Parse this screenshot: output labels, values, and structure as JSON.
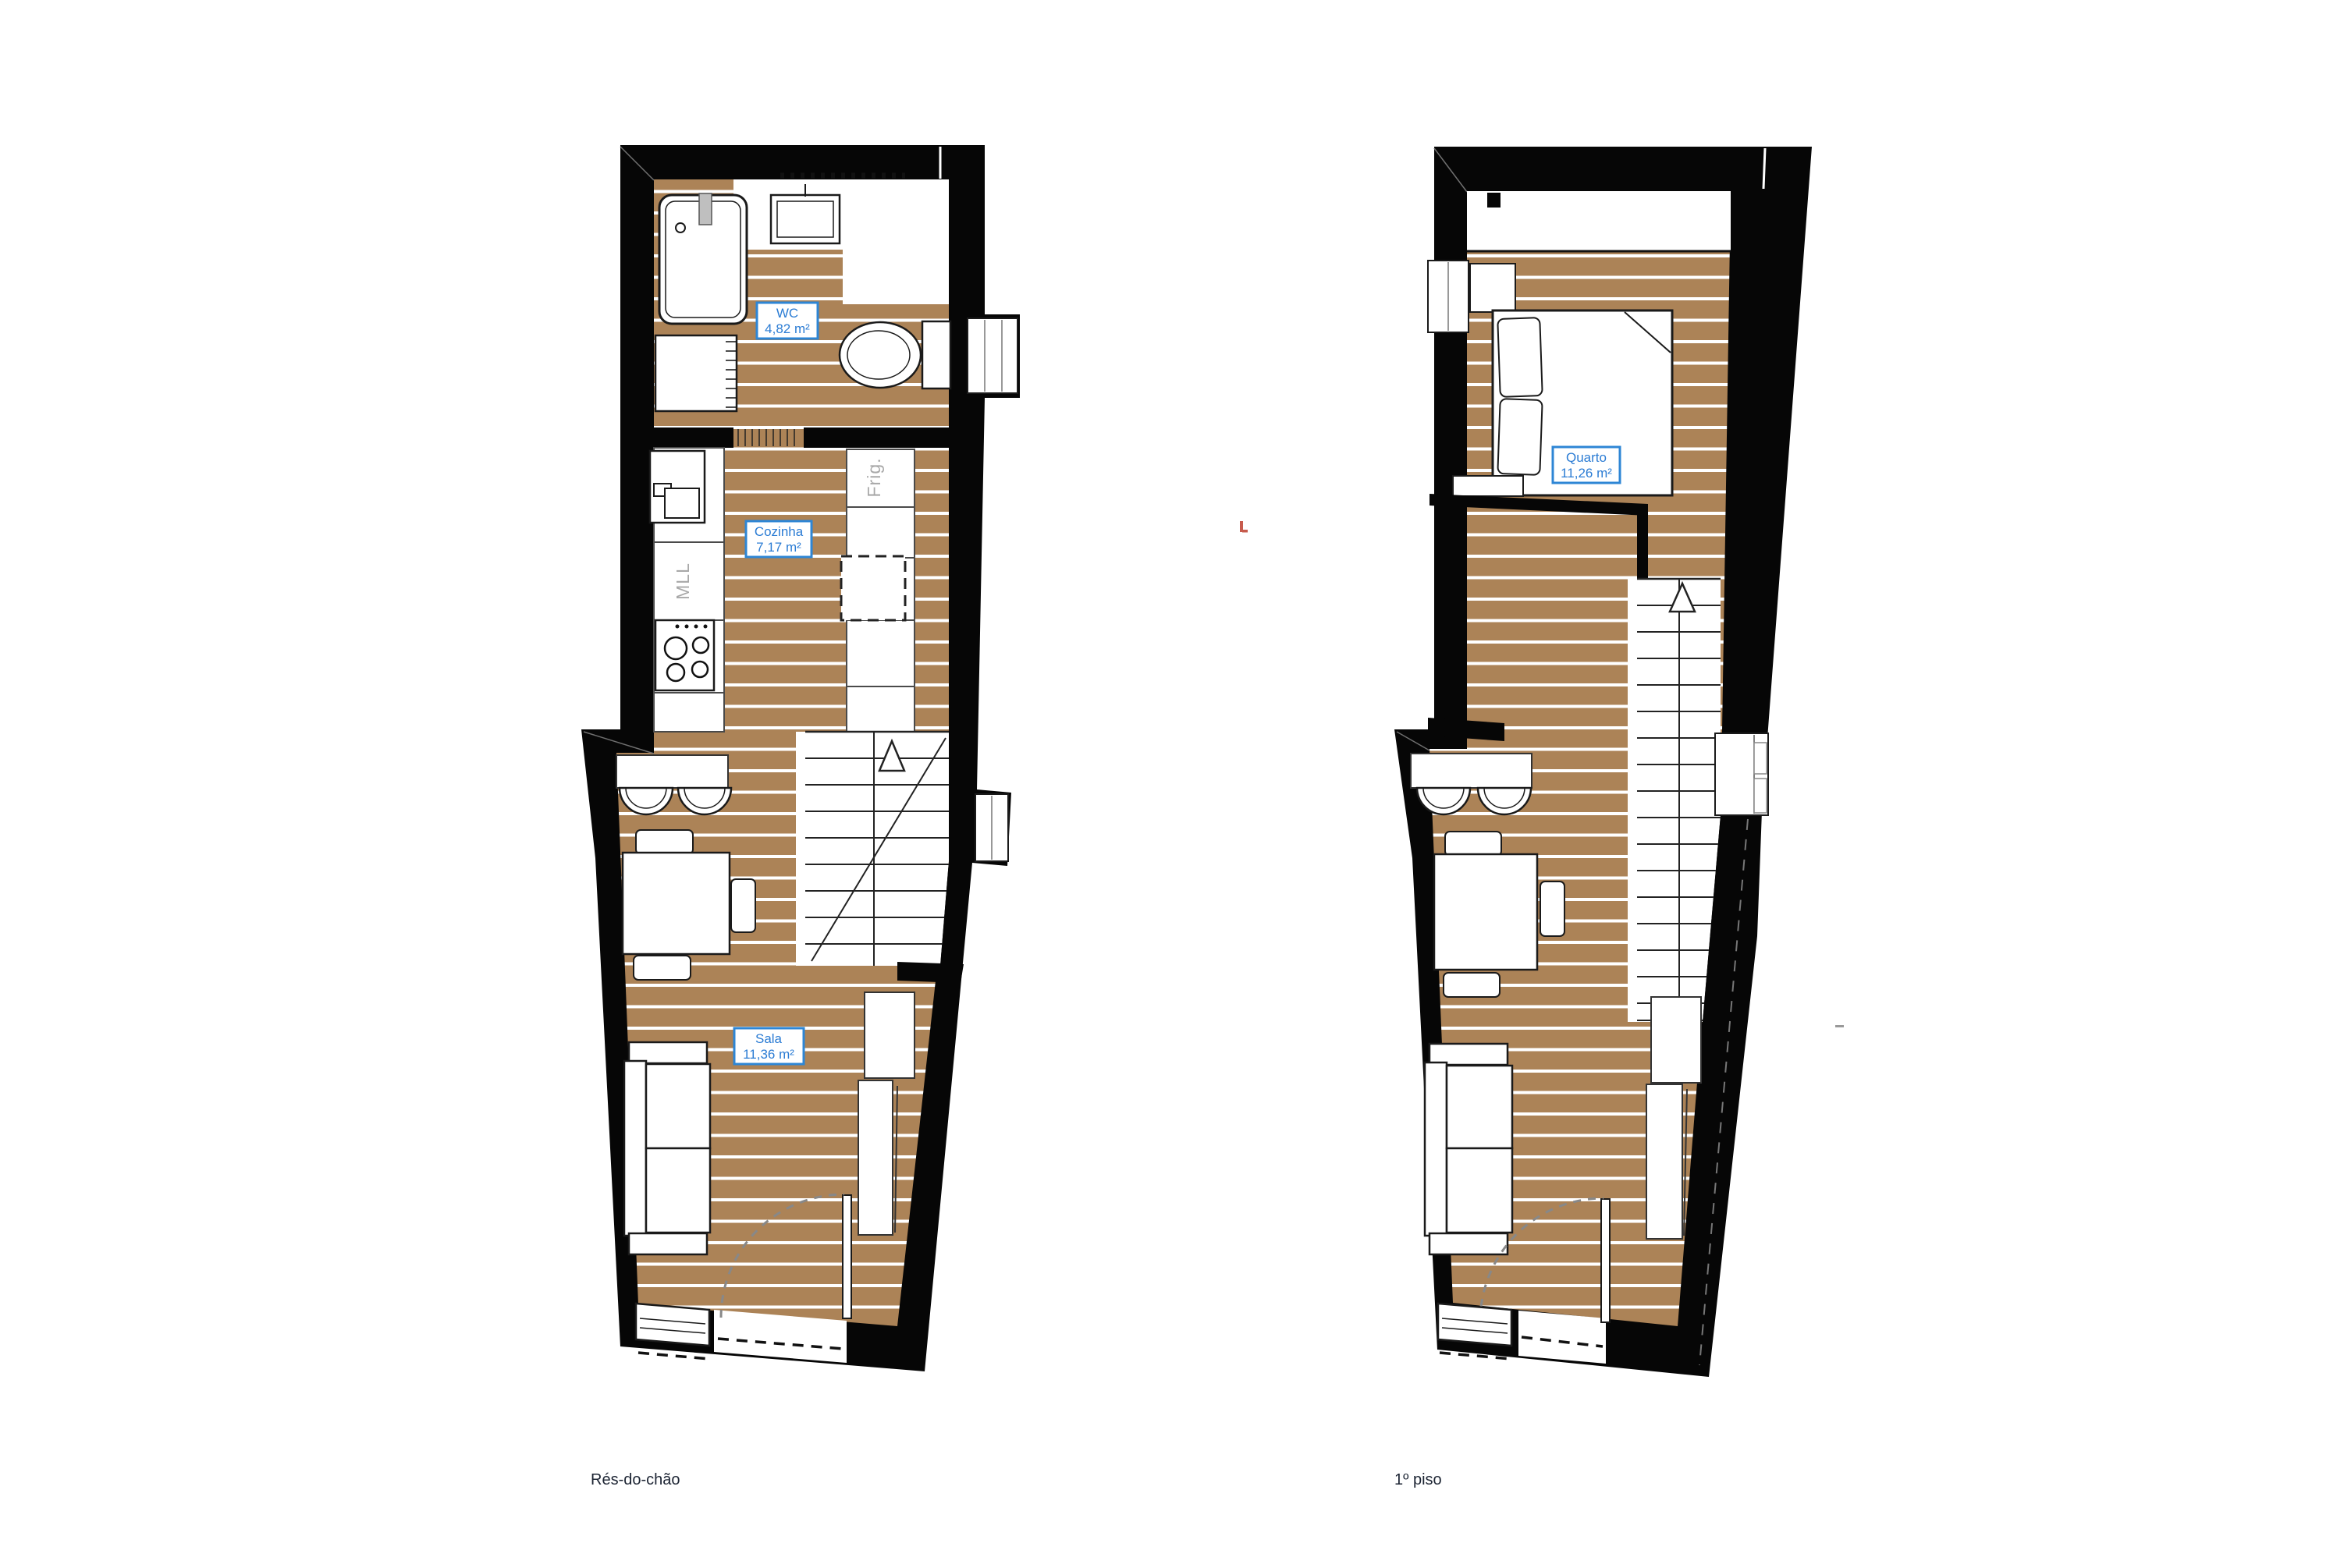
{
  "document": {
    "type": "floor-plan-drawing",
    "background": "#ffffff"
  },
  "colors": {
    "wall": "#060606",
    "floor_wood": "#ac8357",
    "plank_line": "#ffffff",
    "label_blue": "#2b7cd4",
    "label_box_border": "#2e86d5",
    "appliance_gray": "#a8a8a8",
    "title_dark": "#1c2433",
    "door_arc_gray": "#888888",
    "red_tick": "#c75b4d"
  },
  "plans": {
    "ground": {
      "title": "Rés-do-chão",
      "rooms": [
        {
          "name": "WC",
          "area": "4,82 m²"
        },
        {
          "name": "Cozinha",
          "area": "7,17 m²"
        },
        {
          "name": "Sala",
          "area": "11,36 m²"
        }
      ],
      "appliances": [
        {
          "label": "Frig."
        },
        {
          "label": "MLL"
        }
      ]
    },
    "first": {
      "title": "1º piso",
      "rooms": [
        {
          "name": "Quarto",
          "area": "11,26 m²"
        }
      ]
    }
  }
}
